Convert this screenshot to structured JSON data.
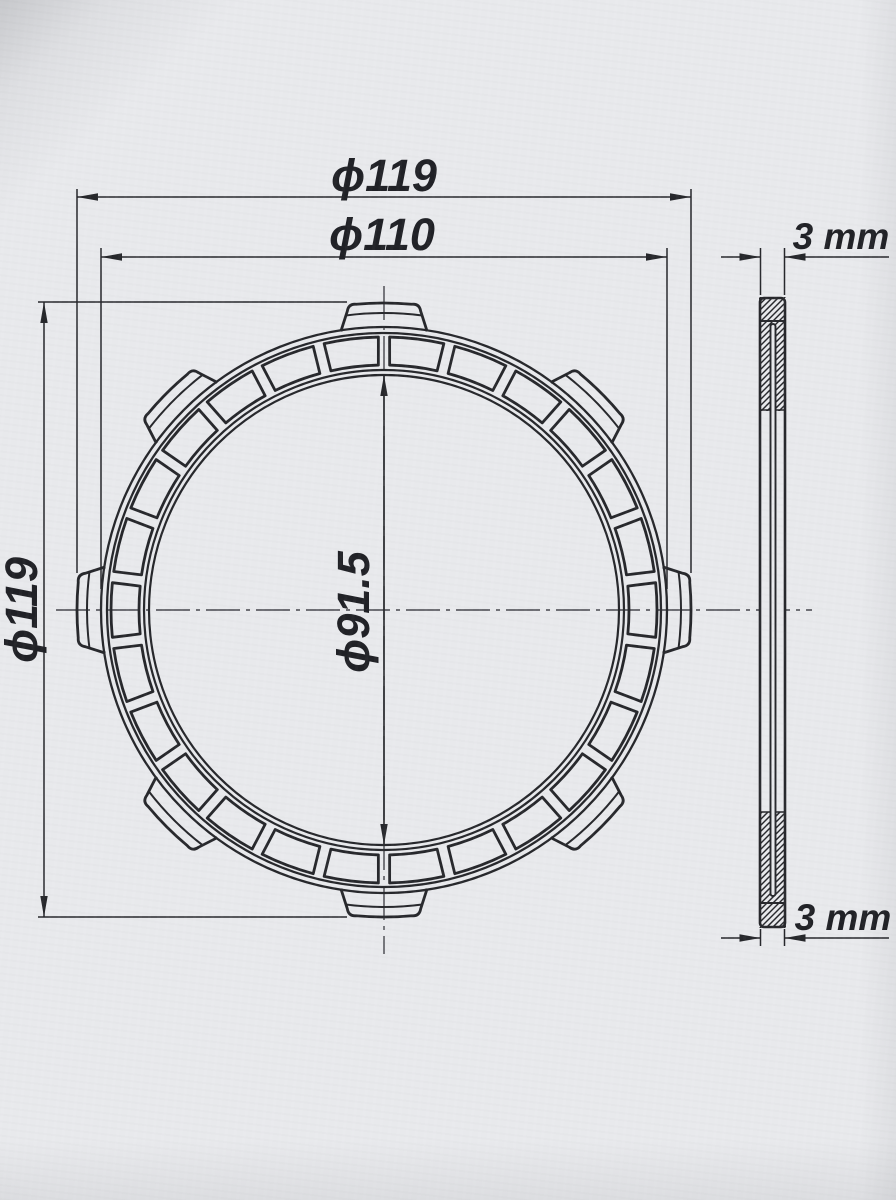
{
  "front_view": {
    "tab_count": 8,
    "segment_count": 26,
    "dim_overall_top": {
      "label": "ϕ119",
      "value": 119,
      "unit": "mm"
    },
    "dim_friction_od": {
      "label": "ϕ110",
      "value": 110,
      "unit": "mm"
    },
    "dim_inner": {
      "label": "ϕ91.5",
      "value": 91.5,
      "unit": "mm"
    },
    "dim_overall_left": {
      "label": "ϕ119",
      "value": 119,
      "unit": "mm"
    }
  },
  "side_view": {
    "dim_thickness_top": {
      "label": "3 mm",
      "value": 3,
      "unit": "mm"
    },
    "dim_thickness_bottom": {
      "label": "3 mm",
      "value": 3,
      "unit": "mm"
    }
  },
  "colors": {
    "paper": "#e8e9ec",
    "ink": "#26272b",
    "thin_line": "#45464c"
  }
}
